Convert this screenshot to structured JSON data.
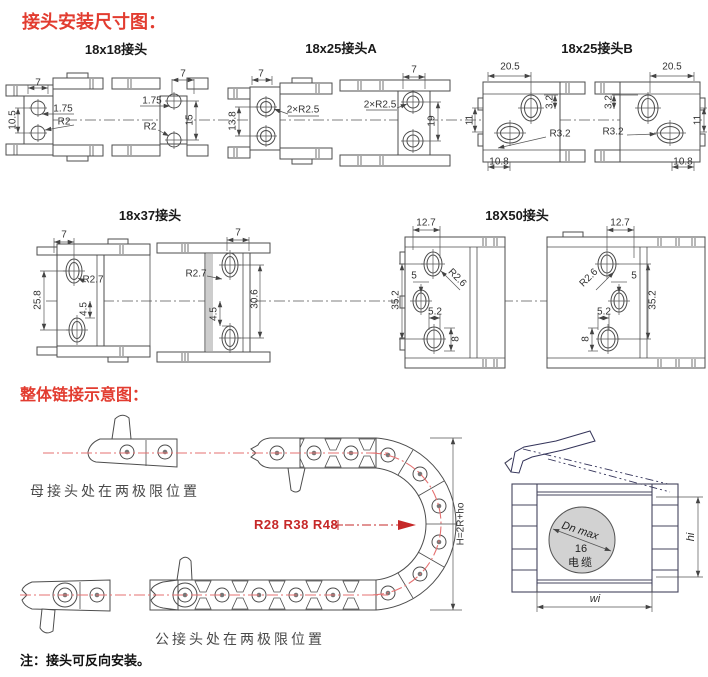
{
  "titles": {
    "main": "接头安装尺寸图：",
    "assembly": "整体链接示意图："
  },
  "note": "注：接头可反向安装。",
  "sections": [
    {
      "label": "18x18接头"
    },
    {
      "label": "18x25接头A"
    },
    {
      "label": "18x25接头B"
    },
    {
      "label": "18x37接头"
    },
    {
      "label": "18X50接头"
    }
  ],
  "assembly": {
    "female_position_label": "母接头处在两极限位置",
    "male_position_label": "公接头处在两极限位置",
    "bend_radius_label": "R28 R38 R48",
    "height_formula": "H=2R+ho",
    "cable_circle": {
      "line1": "Dn max",
      "line2": "16",
      "line3": "电缆"
    },
    "inner_height_label": "hi",
    "inner_width_label": "wi"
  },
  "colors": {
    "title_red": "#e23c30",
    "centerline_red": "#e57070",
    "radius_red": "#c62828",
    "drawing_line": "#4d4d4d",
    "side_view_line": "#44445c",
    "cable_circle_fill": "#d2d2d2"
  },
  "dimension_labels": [
    {
      "n": "g1l-7",
      "view": "18x18-left",
      "t": "7",
      "x": 38,
      "y": 83
    },
    {
      "n": "g1l-10-5",
      "view": "18x18-left",
      "t": "10.5",
      "x": 13,
      "y": 120,
      "r": -90
    },
    {
      "n": "g1l-1-75",
      "view": "18x18-left",
      "t": "1.75",
      "x": 63,
      "y": 109
    },
    {
      "n": "g1l-r2",
      "view": "18x18-left",
      "t": "R2",
      "x": 64,
      "y": 122
    },
    {
      "n": "g1r-7",
      "view": "18x18-right",
      "t": "7",
      "x": 183,
      "y": 74
    },
    {
      "n": "g1r-1-75",
      "view": "18x18-right",
      "t": "1.75",
      "x": 152,
      "y": 101
    },
    {
      "n": "g1r-r2",
      "view": "18x18-right",
      "t": "R2",
      "x": 150,
      "y": 127
    },
    {
      "n": "g1r-15",
      "view": "18x18-right",
      "t": "15",
      "x": 190,
      "y": 120,
      "r": -90
    },
    {
      "n": "g2l-7",
      "view": "18x25a-left",
      "t": "7",
      "x": 261,
      "y": 74
    },
    {
      "n": "g2l-13-8",
      "view": "18x25a-left",
      "t": "13.8",
      "x": 233,
      "y": 121,
      "r": -90
    },
    {
      "n": "g2l-2xr2-5",
      "view": "18x25a-left",
      "t": "2×R2.5",
      "x": 303,
      "y": 110
    },
    {
      "n": "g2r-7",
      "view": "18x25a-right",
      "t": "7",
      "x": 414,
      "y": 70
    },
    {
      "n": "g2r-2xr2-5",
      "view": "18x25a-right",
      "t": "2×R2.5",
      "x": 380,
      "y": 105
    },
    {
      "n": "g2r-19",
      "view": "18x25a-right",
      "t": "19",
      "x": 432,
      "y": 121,
      "r": -90
    },
    {
      "n": "g3l-20-5",
      "view": "18x25b-left",
      "t": "20.5",
      "x": 510,
      "y": 67
    },
    {
      "n": "g3l-3-2",
      "view": "18x25b-left",
      "t": "3.2",
      "x": 550,
      "y": 102,
      "r": -90
    },
    {
      "n": "g3l-11",
      "view": "18x25b-left",
      "t": "11",
      "x": 470,
      "y": 120,
      "r": -90
    },
    {
      "n": "g3l-r3-2",
      "view": "18x25b-left",
      "t": "R3.2",
      "x": 560,
      "y": 134
    },
    {
      "n": "g3l-10-8",
      "view": "18x25b-left",
      "t": "10.8",
      "x": 499,
      "y": 162
    },
    {
      "n": "g3r-20-5",
      "view": "18x25b-right",
      "t": "20.5",
      "x": 672,
      "y": 67
    },
    {
      "n": "g3r-3-2",
      "view": "18x25b-right",
      "t": "3.2",
      "x": 609,
      "y": 102,
      "r": -90
    },
    {
      "n": "g3r-11",
      "view": "18x25b-right",
      "t": "11",
      "x": 698,
      "y": 120,
      "r": -90
    },
    {
      "n": "g3r-r3-2",
      "view": "18x25b-right",
      "t": "R3.2",
      "x": 613,
      "y": 132
    },
    {
      "n": "g3r-10-8",
      "view": "18x25b-right",
      "t": "10.8",
      "x": 683,
      "y": 162
    },
    {
      "n": "g4l-7",
      "view": "18x37-left",
      "t": "7",
      "x": 64,
      "y": 235
    },
    {
      "n": "g4l-r2-7",
      "view": "18x37-left",
      "t": "R2.7",
      "x": 93,
      "y": 280
    },
    {
      "n": "g4l-25-8",
      "view": "18x37-left",
      "t": "25.8",
      "x": 38,
      "y": 300,
      "r": -90
    },
    {
      "n": "g4l-4-5",
      "view": "18x37-left",
      "t": "4.5",
      "x": 84,
      "y": 309,
      "r": -90
    },
    {
      "n": "g4r-7",
      "view": "18x37-right",
      "t": "7",
      "x": 238,
      "y": 233
    },
    {
      "n": "g4r-r2-7",
      "view": "18x37-right",
      "t": "R2.7",
      "x": 196,
      "y": 274
    },
    {
      "n": "g4r-30-6",
      "view": "18x37-right",
      "t": "30.6",
      "x": 255,
      "y": 299,
      "r": -90
    },
    {
      "n": "g4r-4-5",
      "view": "18x37-right",
      "t": "4.5",
      "x": 214,
      "y": 314,
      "r": -90
    },
    {
      "n": "g5l-12-7",
      "view": "18x50-left",
      "t": "12.7",
      "x": 426,
      "y": 223
    },
    {
      "n": "g5l-r2-6",
      "view": "18x50-left",
      "t": "R2.6",
      "x": 457,
      "y": 278,
      "r": 45
    },
    {
      "n": "g5l-5",
      "view": "18x50-left",
      "t": "5",
      "x": 414,
      "y": 276
    },
    {
      "n": "g5l-35-2",
      "view": "18x50-left",
      "t": "35.2",
      "x": 396,
      "y": 300,
      "r": -90
    },
    {
      "n": "g5l-5-2",
      "view": "18x50-left",
      "t": "5.2",
      "x": 435,
      "y": 312
    },
    {
      "n": "g5l-8",
      "view": "18x50-left",
      "t": "8",
      "x": 456,
      "y": 339,
      "r": -90
    },
    {
      "n": "g5r-12-7",
      "view": "18x50-right",
      "t": "12.7",
      "x": 620,
      "y": 223
    },
    {
      "n": "g5r-r2-6",
      "view": "18x50-right",
      "t": "R2.6",
      "x": 589,
      "y": 278,
      "r": -45
    },
    {
      "n": "g5r-5",
      "view": "18x50-right",
      "t": "5",
      "x": 634,
      "y": 276
    },
    {
      "n": "g5r-35-2",
      "view": "18x50-right",
      "t": "35.2",
      "x": 653,
      "y": 300,
      "r": -90
    },
    {
      "n": "g5r-5-2",
      "view": "18x50-right",
      "t": "5.2",
      "x": 604,
      "y": 312
    },
    {
      "n": "g5r-8",
      "view": "18x50-right",
      "t": "8",
      "x": 586,
      "y": 339,
      "r": -90
    }
  ]
}
